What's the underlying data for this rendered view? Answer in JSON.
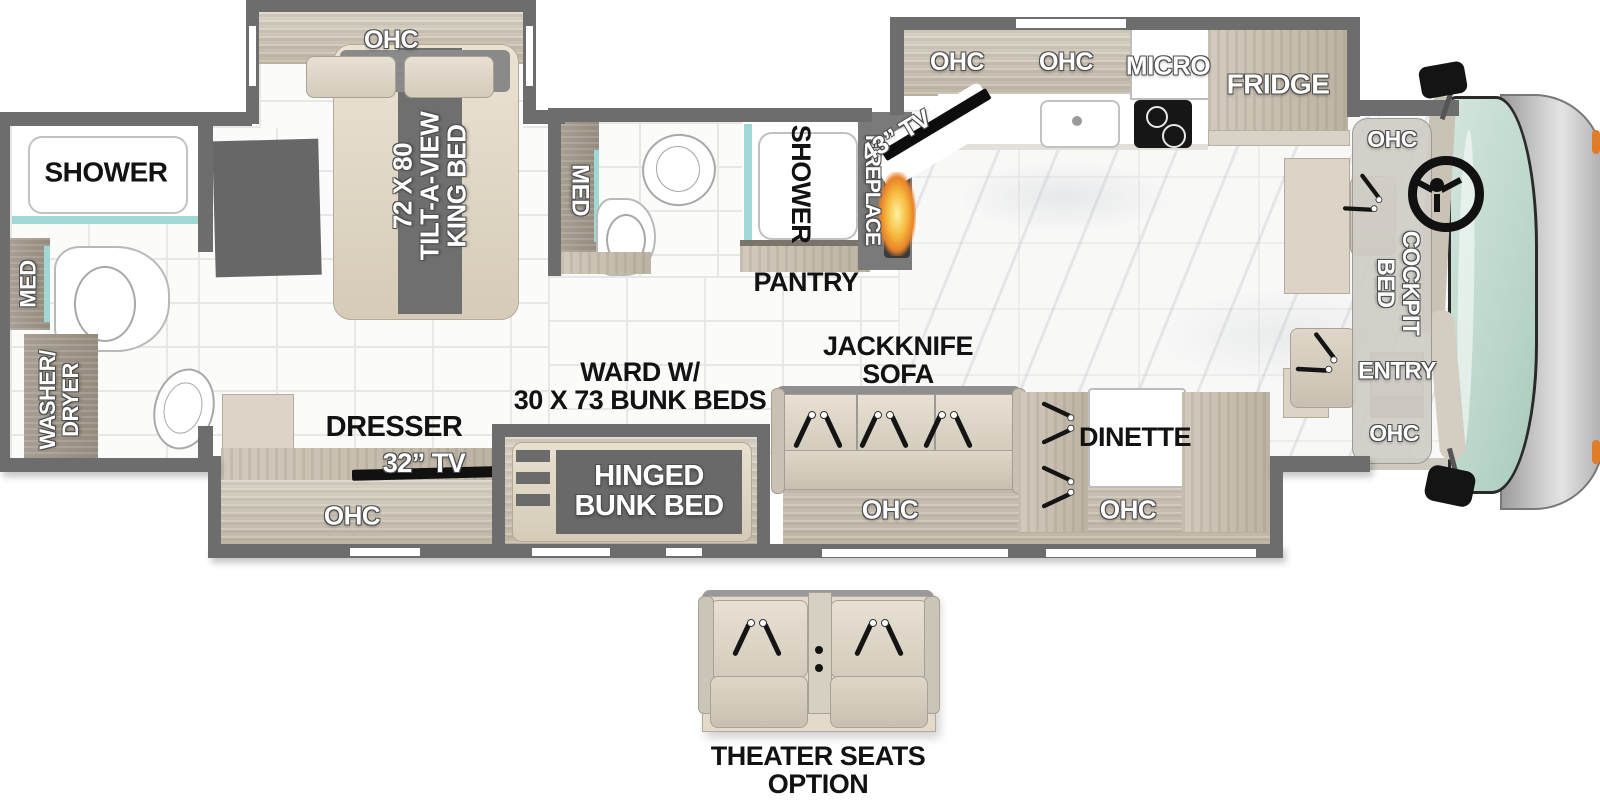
{
  "diagram_title": "Class A motorhome floor plan",
  "colors": {
    "wall": "#6d6d6d",
    "teal_accent": "#9fd8d5",
    "wood_light": "#d3cbbd",
    "wood_dark": "#9c9386",
    "flame_orange": "#ef9a33",
    "windshield": "#c6ded4",
    "front_cap": "#bdbdbd",
    "marker_light_orange": "#e07b28",
    "label_dark": "#121212",
    "label_light": "#ffffff"
  },
  "labels": {
    "king_ohc": "OHC",
    "king_bed": "72 X 80\nTILT-A-VIEW\nKING BED",
    "rear_shower": "SHOWER",
    "rear_med": "MED",
    "washer_dryer": "WASHER/\nDRYER",
    "mid_med": "MED",
    "mid_shower": "SHOWER",
    "pantry": "PANTRY",
    "fireplace": "FIREPLACE",
    "tv_43": "43” TV",
    "kitchen_ohc_left": "OHC",
    "kitchen_ohc_right": "OHC",
    "micro": "MICRO",
    "fridge": "FRIDGE",
    "cab_ohc_top": "OHC",
    "cockpit_bed": "COCKPIT\nBED",
    "entry": "ENTRY",
    "cab_ohc_bottom": "OHC",
    "jackknife_sofa": "JACKKNIFE\nSOFA",
    "sofa_ohc": "OHC",
    "dinette": "DINETTE",
    "dinette_ohc": "OHC",
    "ward_bunk": "WARD W/\n30 X 73 BUNK BEDS",
    "hinged_bunk": "HINGED\nBUNK BED",
    "dresser": "DRESSER",
    "tv_32": "32” TV",
    "dresser_ohc": "OHC",
    "theater_option": "THEATER SEATS\nOPTION"
  }
}
